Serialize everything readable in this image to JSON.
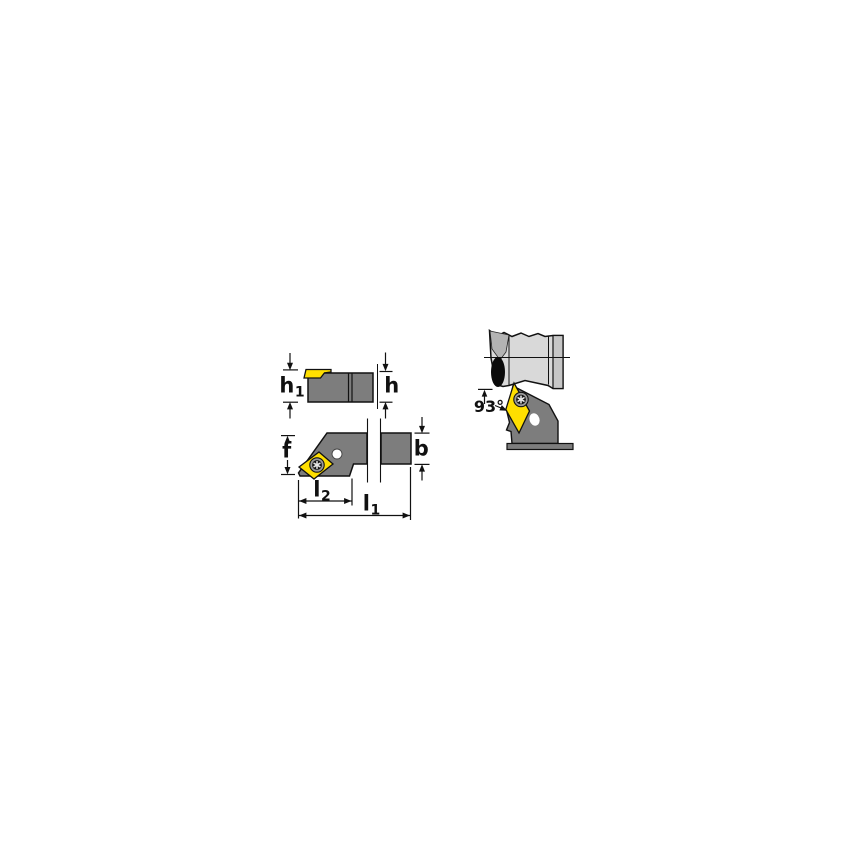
{
  "drawing": {
    "angle_label": "93°",
    "dimension_labels": {
      "h1": {
        "base": "h",
        "sub": "1"
      },
      "h": {
        "base": "h",
        "sub": ""
      },
      "f": {
        "base": "f",
        "sub": ""
      },
      "b": {
        "base": "b",
        "sub": ""
      },
      "l2": {
        "base": "l",
        "sub": "2"
      },
      "l1": {
        "base": "l",
        "sub": "1"
      }
    }
  },
  "colors": {
    "background": "#ffffff",
    "outline": "#111111",
    "tool_body_gray": "#7d7d7d",
    "insert_yellow": "#ffdf00",
    "workpiece_gray": "#d9d9d9",
    "workpiece_dark_gray": "#b3b3b3",
    "workpiece_band_gray": "#c6c6c6"
  }
}
